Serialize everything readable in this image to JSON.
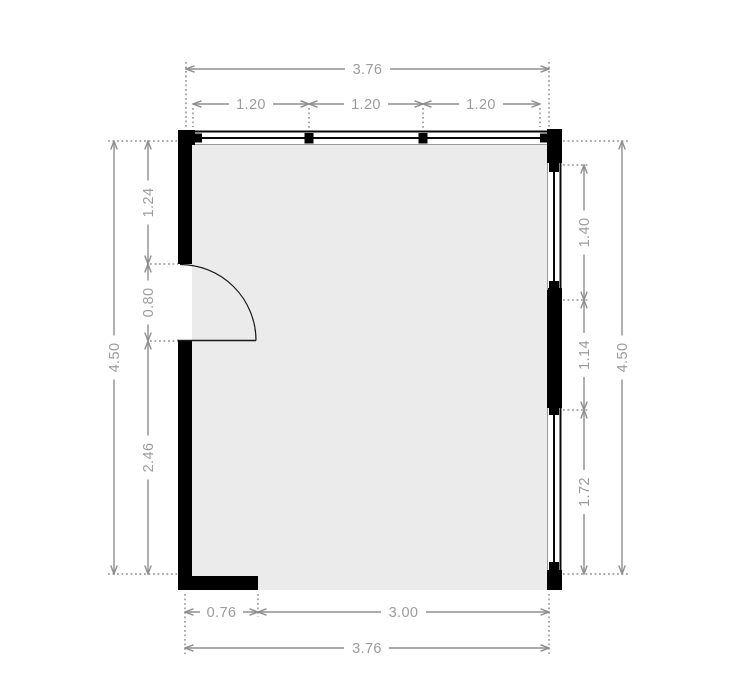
{
  "floorplan": {
    "dimensions_top": {
      "overall": "3.76",
      "window_widths": [
        "1.20",
        "1.20",
        "1.20"
      ]
    },
    "dimensions_bottom": {
      "wall_segment": "0.76",
      "opening": "3.00",
      "overall": "3.76"
    },
    "dimensions_left": {
      "overall": "4.50",
      "segments": [
        "1.24",
        "0.80",
        "2.46"
      ]
    },
    "dimensions_right": {
      "overall": "4.50",
      "segments": [
        "1.40",
        "1.14",
        "1.72"
      ]
    },
    "colors": {
      "wall": "#000000",
      "room_fill": "#ebebeb",
      "dimension_line": "#8f8f8f",
      "dimension_text": "#9c9c9c",
      "background": "#ffffff"
    }
  }
}
